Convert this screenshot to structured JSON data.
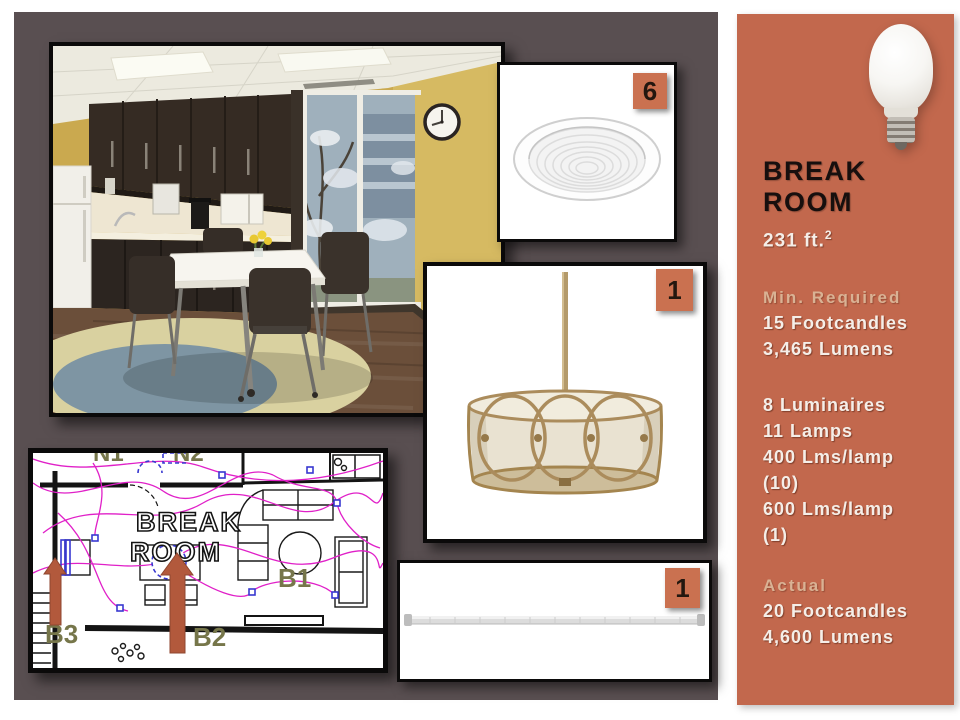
{
  "colors": {
    "panel": "#594f51",
    "sidebar": "#c2684d",
    "badge": "#ca7150",
    "muted_heading": "#d9b294",
    "plan_label_olive": "#76764a",
    "plan_magenta": "#e020c8",
    "plan_blue": "#3838d0",
    "arrow": "#b2593c"
  },
  "sidebar": {
    "title_line1": "BREAK",
    "title_line2": "ROOM",
    "area": "231 ft.",
    "area_sup": "2",
    "min_required_heading": "Min. Required",
    "min_required_lines": [
      "15 Footcandles",
      "3,465 Lumens"
    ],
    "fixture_lines": [
      "8 Luminaires",
      "11 Lamps",
      "400 Lms/lamp",
      "(10)",
      "600 Lms/lamp",
      "(1)"
    ],
    "actual_heading": "Actual",
    "actual_lines": [
      "20 Footcandles",
      "4,600 Lumens"
    ]
  },
  "products": {
    "recessed_badge": "6",
    "pendant_badge": "1",
    "tube_badge": "1"
  },
  "floorplan": {
    "room_line1": "BREAK",
    "room_line2": "ROOM",
    "b1": "B1",
    "b2": "B2",
    "b3": "B3",
    "partial_label_1": "N1",
    "partial_label_2": "N2"
  }
}
